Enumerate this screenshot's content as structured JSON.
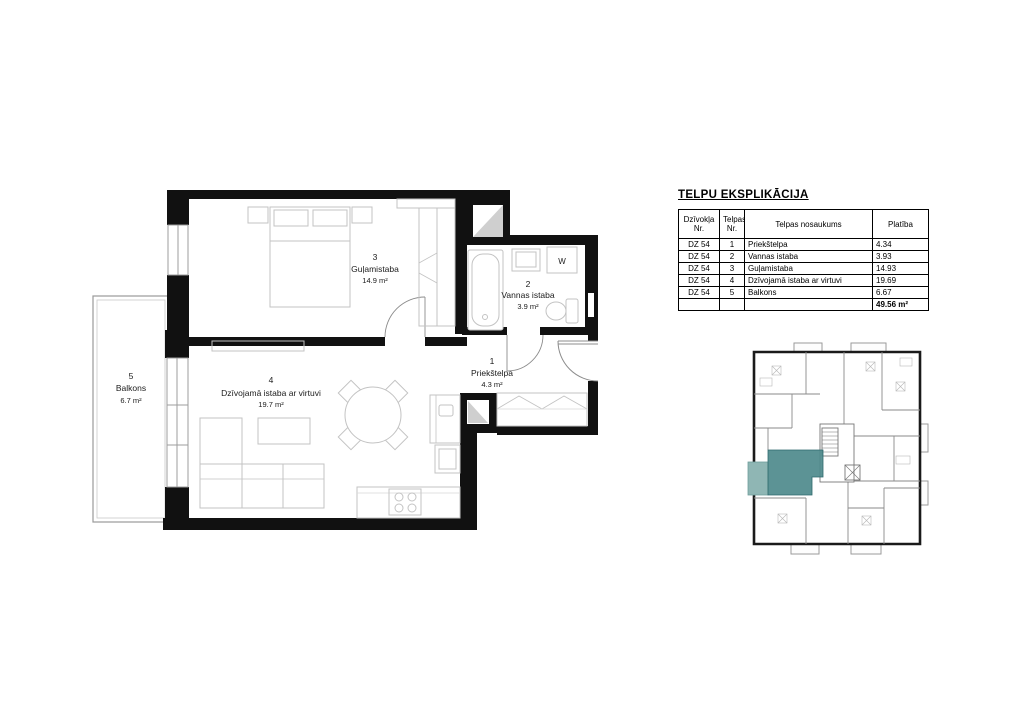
{
  "explication": {
    "title": "TELPU EKSPLIKĀCIJA",
    "headers": {
      "col1": "Dzīvokļa\nNr.",
      "col2": "Telpas\nNr.",
      "col3": "Telpas nosaukums",
      "col4": "Platība"
    },
    "rows": [
      {
        "dz": "DZ 54",
        "nr": "1",
        "name": "Priekštelpa",
        "area": "4.34"
      },
      {
        "dz": "DZ 54",
        "nr": "2",
        "name": "Vannas istaba",
        "area": "3.93"
      },
      {
        "dz": "DZ 54",
        "nr": "3",
        "name": "Guļamistaba",
        "area": "14.93"
      },
      {
        "dz": "DZ 54",
        "nr": "4",
        "name": "Dzīvojamā istaba ar virtuvi",
        "area": "19.69"
      },
      {
        "dz": "DZ 54",
        "nr": "5",
        "name": "Balkons",
        "area": "6.67"
      }
    ],
    "total": "49.56 m²"
  },
  "floor_plan": {
    "rooms": [
      {
        "nr": "1",
        "name": "Priekštelpa",
        "area": "4.3 m²"
      },
      {
        "nr": "2",
        "name": "Vannas istaba",
        "area": "3.9 m²"
      },
      {
        "nr": "3",
        "name": "Guļamistaba",
        "area": "14.9 m²"
      },
      {
        "nr": "4",
        "name": "Dzīvojamā istaba ar virtuvi",
        "area": "19.7 m²"
      },
      {
        "nr": "5",
        "name": "Balkons",
        "area": "6.7 m²"
      }
    ],
    "washer_label": "W"
  },
  "overview": {
    "highlight_color": "#4e8a8c",
    "balcony_highlight_color": "#8fb6b4"
  }
}
